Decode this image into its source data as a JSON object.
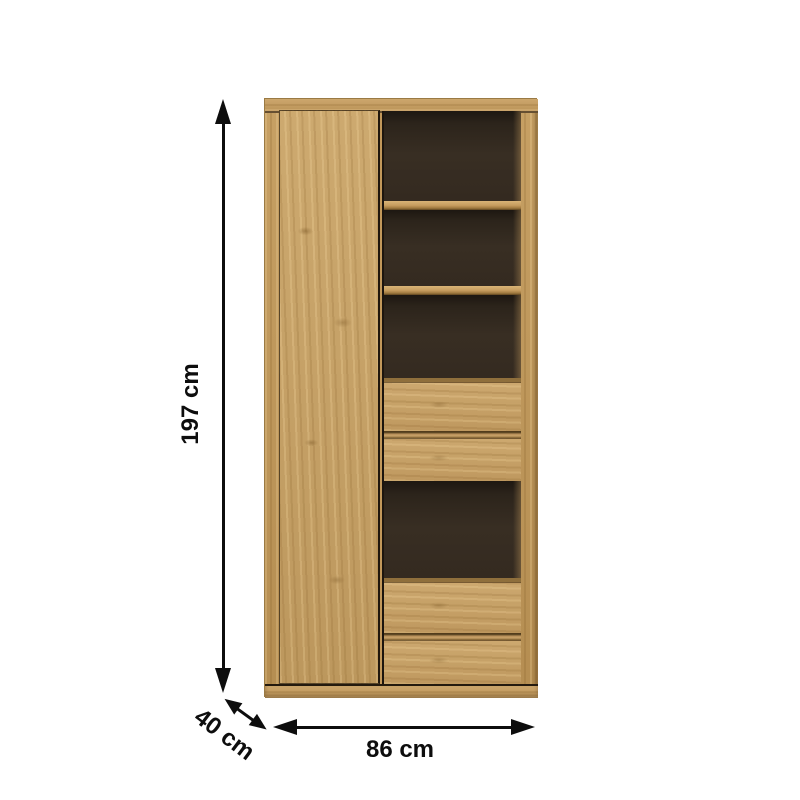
{
  "diagram": {
    "type": "furniture-dimension-diagram",
    "product": "tall oak cabinet with left door, open shelves and drawers",
    "dimensions": {
      "height": {
        "label": "197 cm",
        "orientation": "vertical"
      },
      "depth": {
        "label": "40 cm",
        "orientation": "diagonal"
      },
      "width": {
        "label": "86 cm",
        "orientation": "horizontal"
      }
    },
    "icons": {
      "height_arrow": "double-headed-vertical-arrow-icon",
      "depth_arrow": "double-headed-diagonal-arrow-icon",
      "width_arrow": "double-headed-horizontal-arrow-icon"
    },
    "colors": {
      "background": "#ffffff",
      "oak": "#c7a165",
      "oak_dark": "#9d783e",
      "interior": "#342a20",
      "arrow": "#0d0d0d",
      "text": "#0d0d0d"
    }
  }
}
